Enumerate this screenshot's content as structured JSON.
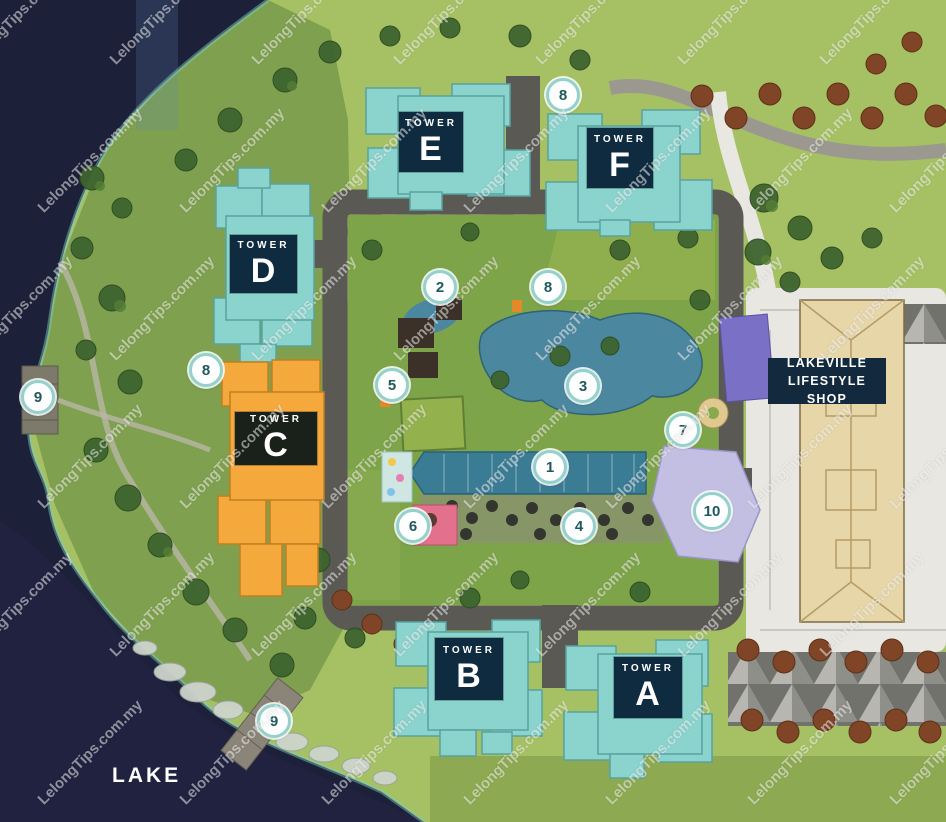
{
  "map": {
    "name": "Lakeville residential development site plan",
    "lake_label": "LAKE"
  },
  "watermark": {
    "text": "LelongTips.com.my"
  },
  "shop": {
    "line1": "LAKEVILLE",
    "line2": "LIFESTYLE SHOP"
  },
  "towers": {
    "a": {
      "prefix": "TOWER",
      "letter": "A"
    },
    "b": {
      "prefix": "TOWER",
      "letter": "B"
    },
    "c": {
      "prefix": "TOWER",
      "letter": "C"
    },
    "d": {
      "prefix": "TOWER",
      "letter": "D"
    },
    "e": {
      "prefix": "TOWER",
      "letter": "E"
    },
    "f": {
      "prefix": "TOWER",
      "letter": "F"
    }
  },
  "markers": [
    {
      "number": "1"
    },
    {
      "number": "2"
    },
    {
      "number": "3"
    },
    {
      "number": "4"
    },
    {
      "number": "5"
    },
    {
      "number": "6"
    },
    {
      "number": "7"
    },
    {
      "number": "8"
    },
    {
      "number": "8"
    },
    {
      "number": "8"
    },
    {
      "number": "9"
    },
    {
      "number": "9"
    },
    {
      "number": "10"
    }
  ],
  "colors": {
    "lake": "#1c2039",
    "land": "#a6c164",
    "hill": "#7fa04e",
    "tower_teal": "#8bd3cd",
    "tower_orange": "#f5a93c",
    "label_navy": "#0f2b40",
    "label_dark_green": "#1a211b",
    "pool_blue": "#3b7c95",
    "pond_blue": "#4c87a0",
    "parcel_lavender": "#c3bfe2",
    "court_purple": "#7a71c6",
    "shop_beige": "#e7d6a8",
    "marker_ring": "#93d2cc",
    "marker_text": "#20585c"
  }
}
